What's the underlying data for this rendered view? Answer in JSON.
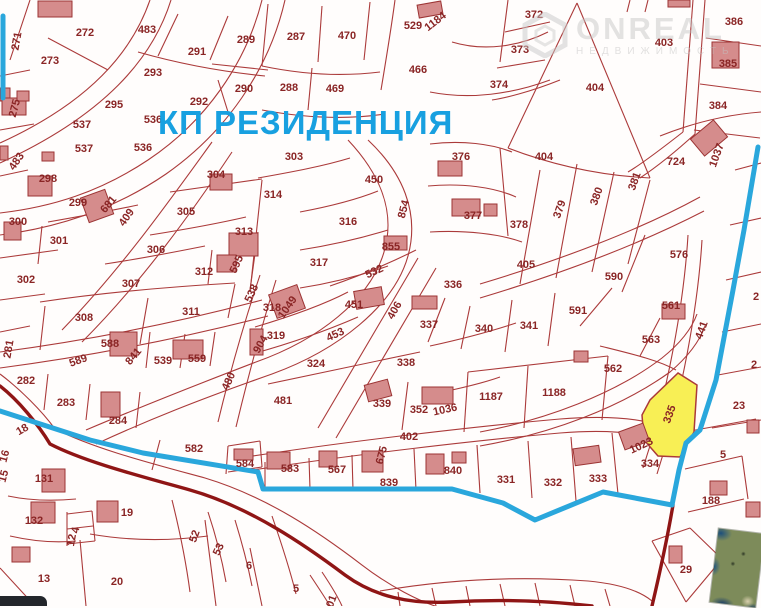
{
  "map": {
    "title": "КП РЕЗИДЕНЦИЯ",
    "title_color": "#18a0e0",
    "watermark": {
      "line1": "ONREAL",
      "line2": "НЕДВИЖИМОСТЬ"
    },
    "highlighted_plot": {
      "number": "335",
      "fill": "#f8ef55"
    },
    "colors": {
      "parcel_line": "#ab3a3a",
      "label_text": "#8a2525",
      "boundary_blue": "#2aa7dc",
      "road_dark": "#8f1515",
      "building_fill": "#d58c8c",
      "building_stroke": "#9c3434",
      "background": "#fffdfc"
    },
    "labels": [
      [
        "271",
        16,
        41,
        -80
      ],
      [
        "272",
        85,
        32,
        0
      ],
      [
        "273",
        50,
        60,
        0
      ],
      [
        "483",
        147,
        29,
        0
      ],
      [
        "291",
        197,
        51,
        0
      ],
      [
        "289",
        246,
        39,
        0
      ],
      [
        "293",
        153,
        72,
        0
      ],
      [
        "290",
        244,
        88,
        0
      ],
      [
        "292",
        199,
        101,
        0
      ],
      [
        "275",
        14,
        108,
        -75
      ],
      [
        "295",
        114,
        104,
        0
      ],
      [
        "537",
        82,
        124,
        0
      ],
      [
        "536",
        153,
        119,
        0
      ],
      [
        "537",
        84,
        148,
        0
      ],
      [
        "536",
        143,
        147,
        0
      ],
      [
        "287",
        296,
        36,
        0
      ],
      [
        "470",
        347,
        35,
        0
      ],
      [
        "529",
        413,
        25,
        0
      ],
      [
        "1184",
        435,
        21,
        -38
      ],
      [
        "466",
        418,
        69,
        0
      ],
      [
        "288",
        289,
        87,
        0
      ],
      [
        "469",
        335,
        88,
        0
      ],
      [
        "374",
        499,
        84,
        0
      ],
      [
        "372",
        534,
        14,
        0
      ],
      [
        "373",
        520,
        49,
        0
      ],
      [
        "403",
        664,
        42,
        0
      ],
      [
        "386",
        734,
        21,
        0
      ],
      [
        "385",
        728,
        63,
        0
      ],
      [
        "384",
        718,
        105,
        0
      ],
      [
        "404",
        595,
        87,
        0
      ],
      [
        "404",
        544,
        156,
        0
      ],
      [
        "724",
        676,
        161,
        0
      ],
      [
        "1037",
        716,
        155,
        -70
      ],
      [
        "483",
        16,
        161,
        -55
      ],
      [
        "298",
        48,
        178,
        0
      ],
      [
        "299",
        78,
        202,
        0
      ],
      [
        "681",
        108,
        204,
        -50
      ],
      [
        "409",
        126,
        217,
        -55
      ],
      [
        "304",
        216,
        174,
        0
      ],
      [
        "305",
        186,
        211,
        0
      ],
      [
        "300",
        18,
        221,
        0
      ],
      [
        "301",
        59,
        240,
        0
      ],
      [
        "306",
        156,
        249,
        0
      ],
      [
        "313",
        244,
        231,
        0
      ],
      [
        "312",
        204,
        271,
        0
      ],
      [
        "595",
        236,
        264,
        -65
      ],
      [
        "302",
        26,
        279,
        0
      ],
      [
        "307",
        131,
        283,
        0
      ],
      [
        "538",
        251,
        293,
        -65
      ],
      [
        "303",
        294,
        156,
        0
      ],
      [
        "450",
        374,
        179,
        0
      ],
      [
        "376",
        461,
        156,
        0
      ],
      [
        "314",
        273,
        194,
        0
      ],
      [
        "316",
        348,
        221,
        0
      ],
      [
        "854",
        403,
        209,
        -75
      ],
      [
        "377",
        473,
        215,
        0
      ],
      [
        "855",
        391,
        246,
        0
      ],
      [
        "317",
        319,
        262,
        0
      ],
      [
        "532",
        374,
        271,
        -25
      ],
      [
        "336",
        453,
        284,
        0
      ],
      [
        "378",
        519,
        224,
        0
      ],
      [
        "379",
        559,
        209,
        -70
      ],
      [
        "380",
        596,
        196,
        -70
      ],
      [
        "381",
        634,
        181,
        -70
      ],
      [
        "405",
        526,
        264,
        0
      ],
      [
        "576",
        679,
        254,
        0
      ],
      [
        "590",
        614,
        276,
        0
      ],
      [
        "308",
        84,
        317,
        0
      ],
      [
        "311",
        191,
        311,
        0
      ],
      [
        "281",
        8,
        349,
        -80
      ],
      [
        "588",
        110,
        343,
        0
      ],
      [
        "841",
        133,
        356,
        -50
      ],
      [
        "539",
        163,
        360,
        0
      ],
      [
        "559",
        197,
        358,
        0
      ],
      [
        "589",
        78,
        360,
        -20
      ],
      [
        "282",
        26,
        380,
        0
      ],
      [
        "283",
        66,
        402,
        0
      ],
      [
        "284",
        118,
        420,
        0
      ],
      [
        "480",
        228,
        381,
        -65
      ],
      [
        "18",
        22,
        429,
        -30
      ],
      [
        "582",
        194,
        448,
        0
      ],
      [
        "318",
        272,
        307,
        0
      ],
      [
        "1049",
        287,
        307,
        -55
      ],
      [
        "451",
        354,
        304,
        0
      ],
      [
        "406",
        394,
        310,
        -60
      ],
      [
        "337",
        429,
        324,
        0
      ],
      [
        "340",
        484,
        328,
        0
      ],
      [
        "319",
        276,
        335,
        0
      ],
      [
        "904",
        260,
        344,
        -60
      ],
      [
        "453",
        335,
        334,
        -25
      ],
      [
        "324",
        316,
        363,
        0
      ],
      [
        "338",
        406,
        362,
        0
      ],
      [
        "481",
        283,
        400,
        0
      ],
      [
        "339",
        382,
        403,
        0
      ],
      [
        "352",
        419,
        409,
        0
      ],
      [
        "1036",
        445,
        409,
        -12
      ],
      [
        "1187",
        491,
        396,
        0
      ],
      [
        "402",
        409,
        436,
        0
      ],
      [
        "341",
        529,
        325,
        0
      ],
      [
        "591",
        578,
        310,
        0
      ],
      [
        "561",
        671,
        305,
        0
      ],
      [
        "563",
        651,
        339,
        0
      ],
      [
        "441",
        701,
        330,
        -70
      ],
      [
        "562",
        613,
        368,
        0
      ],
      [
        "1188",
        554,
        392,
        0
      ],
      [
        "335",
        669,
        414,
        -70
      ],
      [
        "23",
        739,
        405,
        0
      ],
      [
        "2",
        756,
        296,
        0
      ],
      [
        "2",
        754,
        364,
        0
      ],
      [
        "1023",
        641,
        445,
        -25
      ],
      [
        "131",
        44,
        478,
        0
      ],
      [
        "132",
        34,
        520,
        0
      ],
      [
        "19",
        127,
        512,
        0
      ],
      [
        "4",
        75,
        530,
        -80
      ],
      [
        "12",
        71,
        540,
        -80
      ],
      [
        "13",
        44,
        578,
        0
      ],
      [
        "20",
        117,
        581,
        0
      ],
      [
        "16",
        4,
        456,
        -75
      ],
      [
        "15",
        3,
        476,
        -75
      ],
      [
        "584",
        245,
        463,
        0
      ],
      [
        "52",
        194,
        536,
        -70
      ],
      [
        "53",
        218,
        549,
        -65
      ],
      [
        "6",
        249,
        565,
        0
      ],
      [
        "583",
        290,
        468,
        0
      ],
      [
        "567",
        337,
        469,
        0
      ],
      [
        "675",
        381,
        455,
        -75
      ],
      [
        "839",
        389,
        482,
        0
      ],
      [
        "840",
        453,
        470,
        0
      ],
      [
        "331",
        506,
        479,
        0
      ],
      [
        "332",
        553,
        482,
        0
      ],
      [
        "333",
        598,
        478,
        0
      ],
      [
        "334",
        650,
        463,
        0
      ],
      [
        "5",
        723,
        454,
        0
      ],
      [
        "188",
        711,
        500,
        0
      ],
      [
        "29",
        686,
        569,
        0
      ],
      [
        "5",
        296,
        588,
        0
      ],
      [
        "01",
        331,
        601,
        -70
      ]
    ],
    "buildings": [
      [
        38,
        1,
        34,
        16,
        0
      ],
      [
        0,
        88,
        10,
        13,
        0
      ],
      [
        2,
        98,
        24,
        17,
        0
      ],
      [
        17,
        91,
        12,
        10,
        0
      ],
      [
        0,
        146,
        8,
        14,
        0
      ],
      [
        42,
        152,
        12,
        9,
        0
      ],
      [
        28,
        176,
        24,
        20,
        0
      ],
      [
        84,
        193,
        26,
        26,
        -20
      ],
      [
        4,
        222,
        17,
        18,
        0
      ],
      [
        210,
        174,
        22,
        16,
        0
      ],
      [
        229,
        233,
        29,
        23,
        0
      ],
      [
        217,
        255,
        19,
        17,
        0
      ],
      [
        418,
        3,
        24,
        13,
        -10
      ],
      [
        438,
        161,
        24,
        15,
        0
      ],
      [
        452,
        199,
        28,
        17,
        0
      ],
      [
        484,
        204,
        13,
        12,
        0
      ],
      [
        384,
        236,
        23,
        14,
        0
      ],
      [
        712,
        42,
        27,
        26,
        0
      ],
      [
        668,
        0,
        22,
        7,
        0
      ],
      [
        694,
        127,
        30,
        22,
        -40
      ],
      [
        110,
        332,
        27,
        24,
        0
      ],
      [
        173,
        340,
        30,
        19,
        0
      ],
      [
        101,
        392,
        19,
        25,
        0
      ],
      [
        250,
        329,
        13,
        26,
        0
      ],
      [
        272,
        289,
        30,
        25,
        -20
      ],
      [
        355,
        289,
        28,
        18,
        -10
      ],
      [
        412,
        296,
        25,
        13,
        0
      ],
      [
        366,
        382,
        24,
        17,
        -15
      ],
      [
        422,
        387,
        31,
        17,
        0
      ],
      [
        662,
        304,
        23,
        15,
        0
      ],
      [
        574,
        351,
        14,
        11,
        0
      ],
      [
        621,
        427,
        26,
        19,
        -20
      ],
      [
        42,
        469,
        23,
        23,
        0
      ],
      [
        31,
        502,
        24,
        21,
        0
      ],
      [
        97,
        501,
        21,
        21,
        0
      ],
      [
        12,
        547,
        18,
        15,
        0
      ],
      [
        234,
        449,
        19,
        11,
        0
      ],
      [
        267,
        452,
        23,
        17,
        0
      ],
      [
        319,
        451,
        18,
        16,
        0
      ],
      [
        362,
        451,
        21,
        21,
        0
      ],
      [
        426,
        454,
        18,
        20,
        0
      ],
      [
        452,
        452,
        14,
        11,
        0
      ],
      [
        574,
        447,
        26,
        17,
        -8
      ],
      [
        710,
        481,
        17,
        14,
        0
      ],
      [
        669,
        546,
        13,
        17,
        0
      ],
      [
        747,
        420,
        12,
        13,
        0
      ],
      [
        746,
        502,
        14,
        15,
        0
      ]
    ],
    "parcel_paths": [
      "M150,0 C132,52 90,102 0,143",
      "M171,0 C153,58 105,115 0,163",
      "M262,0 C246,64 205,122 148,160 C100,192 52,207 0,213",
      "M285,0 C269,70 226,132 166,174 C112,211 55,228 0,235",
      "M48,38 L108,70",
      "M30,0 L10,60",
      "M0,76 L30,70",
      "M0,130 L34,124",
      "M178,14 L158,56",
      "M228,16 L210,60",
      "M212,64 L268,70",
      "M138,52 C180,64 225,72 265,76",
      "M218,80 L228,112",
      "M268,4 L262,66",
      "M322,6 L318,62",
      "M370,2 L364,60",
      "M262,66 C300,74 340,77 380,72",
      "M312,68 L308,110",
      "M262,110 C305,118 345,120 385,114",
      "M395,0 C391,30 386,60 381,90",
      "M452,42 C485,52 520,46 548,32",
      "M430,92 C470,100 512,94 550,80",
      "M508,0 L500,62",
      "M505,32 L550,22",
      "M497,68 L545,60",
      "M560,80 C530,92 505,98 492,100",
      "M577,3 L508,148",
      "M577,3 L650,178",
      "M508,148 C560,168 610,176 650,178",
      "M693,0 L683,132",
      "M705,0 L695,134",
      "M706,38 L761,46",
      "M700,84 L761,92",
      "M694,130 L760,138",
      "M630,0 L627,12",
      "M648,0 L645,12",
      "M660,136 C700,120 735,114 761,112",
      "M683,132 C660,150 640,165 628,172",
      "M695,134 C672,155 652,170 640,178",
      "M212,142 C170,200 122,268 62,330",
      "M232,152 C192,212 142,282 82,342",
      "M368,140 C402,172 420,212 408,256 C394,306 338,350 272,374 C198,400 148,420 96,444",
      "M348,140 C380,174 396,212 384,252 C370,300 318,340 256,362 C188,388 138,408 86,430",
      "M260,275 C245,320 230,372 218,422",
      "M276,280 C262,325 248,377 236,427",
      "M0,352 C90,340 180,322 262,300",
      "M0,368 C92,356 182,338 268,316",
      "M418,258 L318,428",
      "M436,268 L336,438",
      "M480,284 C560,260 640,230 700,197",
      "M480,298 C560,274 640,244 704,211",
      "M688,235 C684,302 668,392 643,468",
      "M702,240 C698,306 682,396 657,474",
      "M480,432 C545,420 615,394 662,358 C682,342 692,328 697,314",
      "M480,446 C550,434 620,408 670,372 C690,355 700,340 705,326",
      "M253,456 C350,441 480,426 560,419 C610,415 645,419 668,428",
      "M253,470 C350,455 480,440 560,433 C610,429 643,433 664,442",
      "M540,170 L520,284",
      "M577,164 L556,278",
      "M614,172 L592,272",
      "M650,180 L628,264",
      "M430,144 C462,140 492,144 512,152",
      "M428,186 C462,183 494,187 516,197",
      "M430,232 C466,230 500,234 522,242",
      "M500,148 L508,236",
      "M645,235 L622,292",
      "M612,288 L580,326",
      "M660,318 L640,356",
      "M600,346 C632,354 658,360 676,370",
      "M258,178 C292,172 324,166 350,158",
      "M300,212 C332,206 358,199 378,191",
      "M300,250 C332,245 362,238 388,230",
      "M300,288 C332,283 362,275 388,266",
      "M262,180 L250,292",
      "M150,235 C188,229 220,223 246,217",
      "M105,264 C145,258 175,252 205,246",
      "M48,222 C82,216 114,210 138,205",
      "M42,226 L38,264",
      "M0,258 L58,250",
      "M0,300 L45,294",
      "M212,250 L208,284",
      "M258,232 L250,290",
      "M170,192 C205,187 235,183 262,179",
      "M148,298 L140,344",
      "M40,302 C100,293 165,287 235,283",
      "M235,284 L228,318",
      "M45,306 L40,350",
      "M150,332 L146,368",
      "M185,334 L180,368",
      "M215,332 L210,366",
      "M48,374 L44,410",
      "M90,384 L86,420",
      "M140,392 L136,428",
      "M0,332 L30,326",
      "M255,327 C292,316 325,304 348,292",
      "M252,354 C292,343 328,330 358,317",
      "M330,286 C362,275 392,262 416,250",
      "M268,384 C320,373 372,362 420,352",
      "M445,298 L428,342",
      "M430,346 C462,339 492,331 516,323",
      "M470,306 L461,349",
      "M512,300 L505,352",
      "M555,293 L548,346",
      "M452,390 C470,386 486,382 500,377",
      "M408,382 L402,430",
      "M468,372 L464,432",
      "M468,372 L608,356",
      "M528,366 L524,428",
      "M608,356 L602,420",
      "M265,462 L265,489",
      "M309,458 L310,489",
      "M352,455 L353,490",
      "M414,449 L416,490",
      "M477,445 L480,493",
      "M528,441 L532,498",
      "M571,437 L576,501",
      "M612,433 L618,494",
      "M160,440 L152,470",
      "M228,446 L226,474",
      "M228,446 L260,441",
      "M228,472 L262,467",
      "M260,441 L262,467",
      "M8,496 C32,501 55,501 76,499",
      "M10,536 C32,541 56,543 76,541",
      "M80,540 L86,606",
      "M0,568 L35,606",
      "M90,534 C130,541 170,541 208,536",
      "M67,512 L67,546",
      "M67,514 L92,511",
      "M67,529 L93,526",
      "M67,544 L95,541",
      "M92,511 L95,541",
      "M205,520 L216,606",
      "M250,548 L262,606",
      "M172,500 C180,532 186,562 190,592",
      "M208,512 C216,536 222,560 226,582",
      "M235,520 C243,546 248,566 252,586",
      "M272,516 C282,545 290,570 296,594",
      "M310,575 C320,590 326,599 330,606",
      "M322,572 C332,587 338,597 342,606",
      "M380,591 C450,579 520,576 588,581 C620,584 640,591 652,601",
      "M398,592 L400,606",
      "M432,588 L436,606",
      "M466,586 L470,606",
      "M500,584 L505,606",
      "M535,583 L540,606",
      "M570,585 L575,606",
      "M605,589 L610,606",
      "M685,469 L742,456",
      "M688,512 L744,499",
      "M742,456 L748,499",
      "M690,431 L756,419",
      "M652,541 L690,528",
      "M690,528 L722,559",
      "M722,559 L686,602",
      "M686,602 L652,541",
      "M712,428 L761,420",
      "M718,375 L761,367",
      "M722,332 L761,324",
      "M726,280 L761,272",
      "M730,225 L761,218",
      "M735,170 L761,163",
      "M0,176 L28,170",
      "M0,374 C20,389 42,411 55,429 C95,449 150,463 205,478 C268,497 320,533 362,565 C392,588 420,601 435,606"
    ],
    "dark_roads": [
      "M0,386 C18,400 38,424 50,444 C85,462 140,476 190,490 C250,507 305,545 345,575 C375,597 410,604 450,602 C500,599 550,601 592,606",
      "M673,505 C667,540 660,572 652,606"
    ],
    "blue_paths": [
      "M758,147 L744,230 L733,290 L716,380 L700,430 L686,443 L679,470 L672,505 L603,492 L535,520 L503,503 L452,489 L263,489 L258,472 L143,453 L90,440 L0,411",
      "M3,16 L3,98"
    ],
    "yellow_polygon": "678,373 650,400 642,415 644,440 658,456 680,457 694,432 697,385"
  }
}
